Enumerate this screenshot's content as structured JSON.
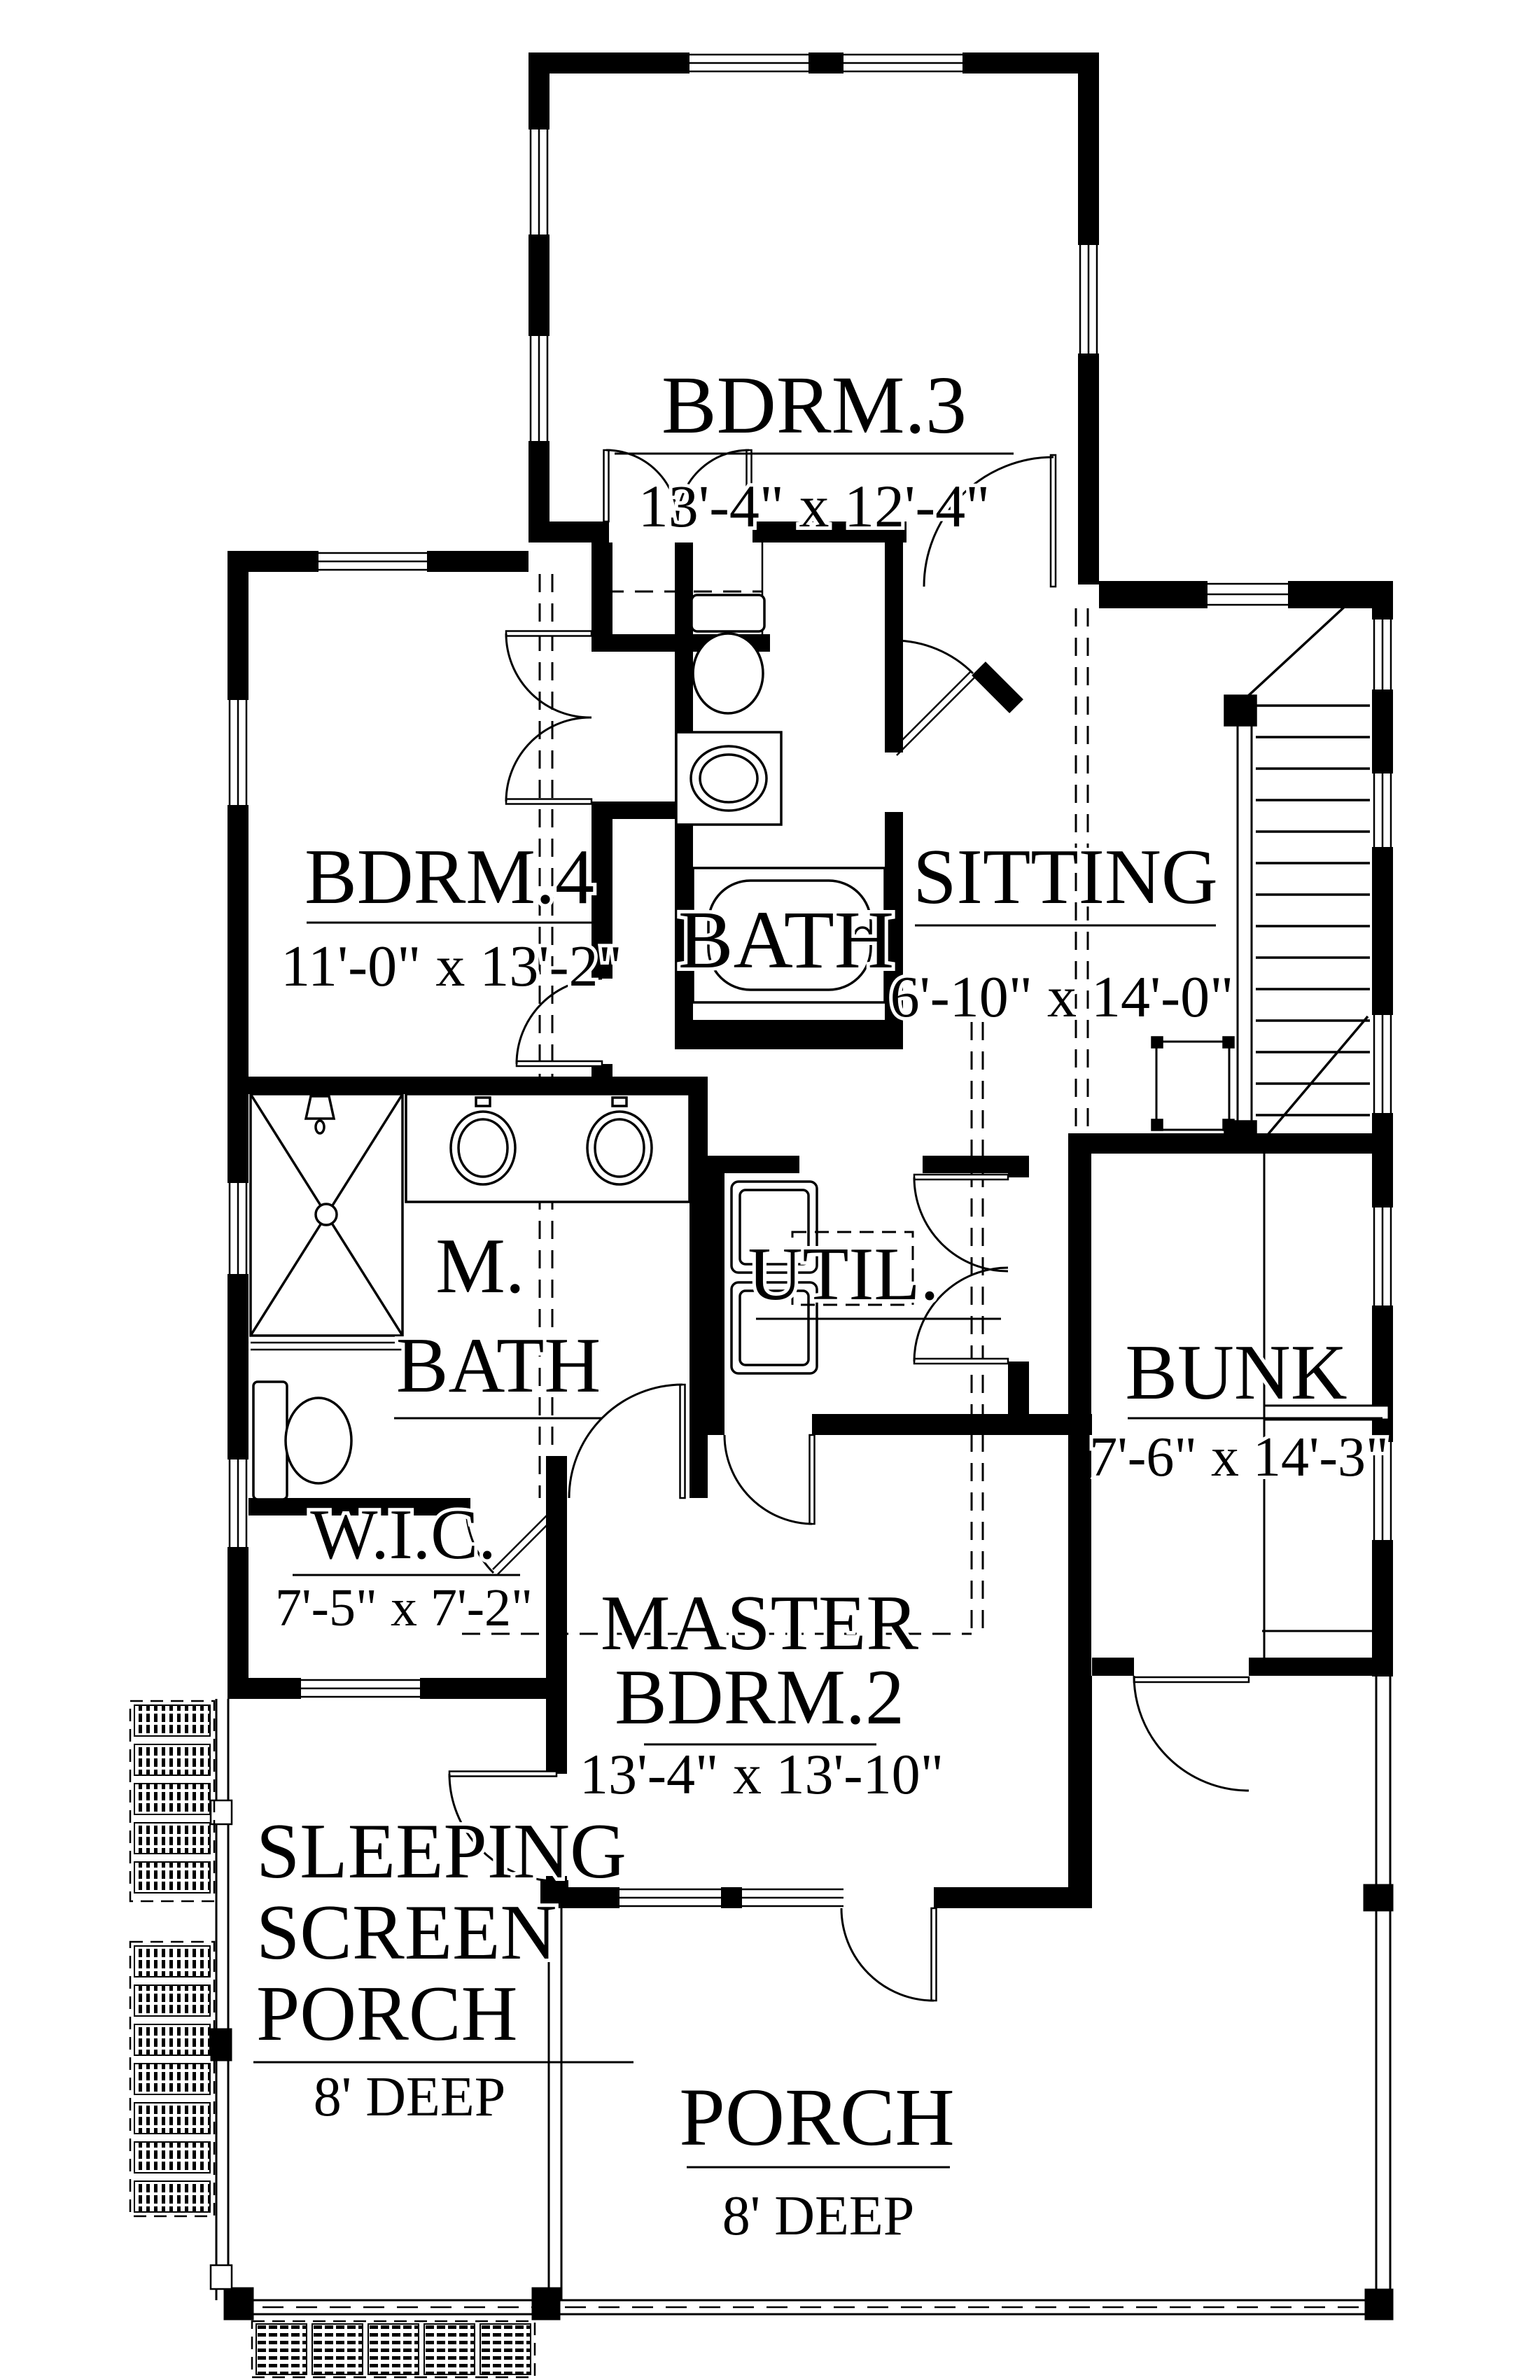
{
  "drawing": {
    "type": "architectural-floor-plan",
    "floor": "upper level",
    "ink_color": "#000000",
    "paper_color": "#ffffff"
  },
  "rooms": {
    "bdrm3": {
      "name": "BDRM.3",
      "dims": "13'-4\" x 12'-4\""
    },
    "bdrm4": {
      "name": "BDRM.4",
      "dims": "11'-0\" x 13'-2\""
    },
    "bath": {
      "name": "BATH"
    },
    "sitting": {
      "name": "SITTING",
      "dims": "6'-10\" x 14'-0\""
    },
    "master_bath": {
      "line1": "M.",
      "line2": "BATH"
    },
    "util": {
      "name": "UTIL."
    },
    "bunk": {
      "name": "BUNK",
      "dims": "7'-6\" x 14'-3\""
    },
    "wic": {
      "name": "W.I.C.",
      "dims": "7'-5\" x 7'-2\""
    },
    "master": {
      "line1": "MASTER",
      "line2": "BDRM.2",
      "dims": "13'-4\" x 13'-10\""
    },
    "sleeping_porch": {
      "line1": "SLEEPING",
      "line2": "SCREEN",
      "line3": "PORCH",
      "dims": "8' DEEP"
    },
    "porch": {
      "name": "PORCH",
      "dims": "8' DEEP"
    }
  }
}
